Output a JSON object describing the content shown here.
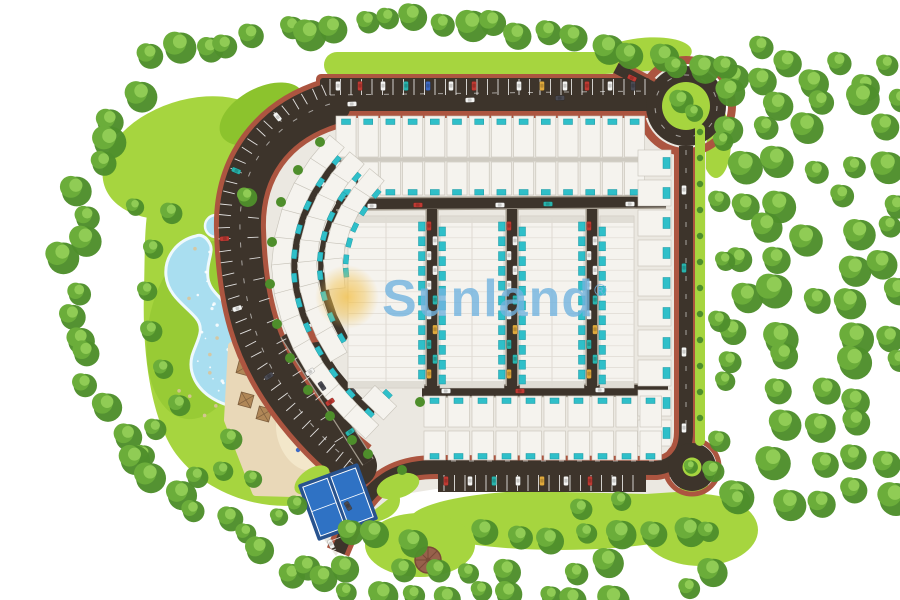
{
  "watermark": {
    "brand": "Sunland",
    "registered": "®"
  },
  "scene": {
    "type": "residential-masterplan-aerial-render"
  },
  "palette": {
    "background": "#ffffff",
    "lawn": "#a6d53f",
    "lawnDeep": "#8cc32d",
    "treeDark": "#4e8e2b",
    "treeMid": "#6bad3a",
    "treeLight": "#90cc55",
    "road": "#3d342b",
    "curb": "#a29a8d",
    "sidewalk": "#ac5540",
    "pad": "#ebe8e1",
    "house": "#f5f3ee",
    "houseEdge": "#c6c2b8",
    "houseLine": "#dedad2",
    "houseGray": "#d7d3cb",
    "pool": "#2fbfc9",
    "poolDark": "#18959f",
    "lagoon": "#a9def0",
    "sand": "#e9d8b8",
    "sandLight": "#f3e7ca",
    "court": "#2f72c4",
    "courtPad": "#28538f",
    "hutRoof": "#97614b",
    "hutRoofDark": "#7a4a37",
    "sun": "#f3c14b",
    "watermark": "#72b4e0",
    "carWhite": "#f4f4f2",
    "carRed": "#bf3a33",
    "carTeal": "#28b4ad",
    "carYellow": "#e0a93c",
    "carBlue": "#3e6ac4",
    "carDark": "#4b4b53",
    "carGreen": "#46954d"
  }
}
